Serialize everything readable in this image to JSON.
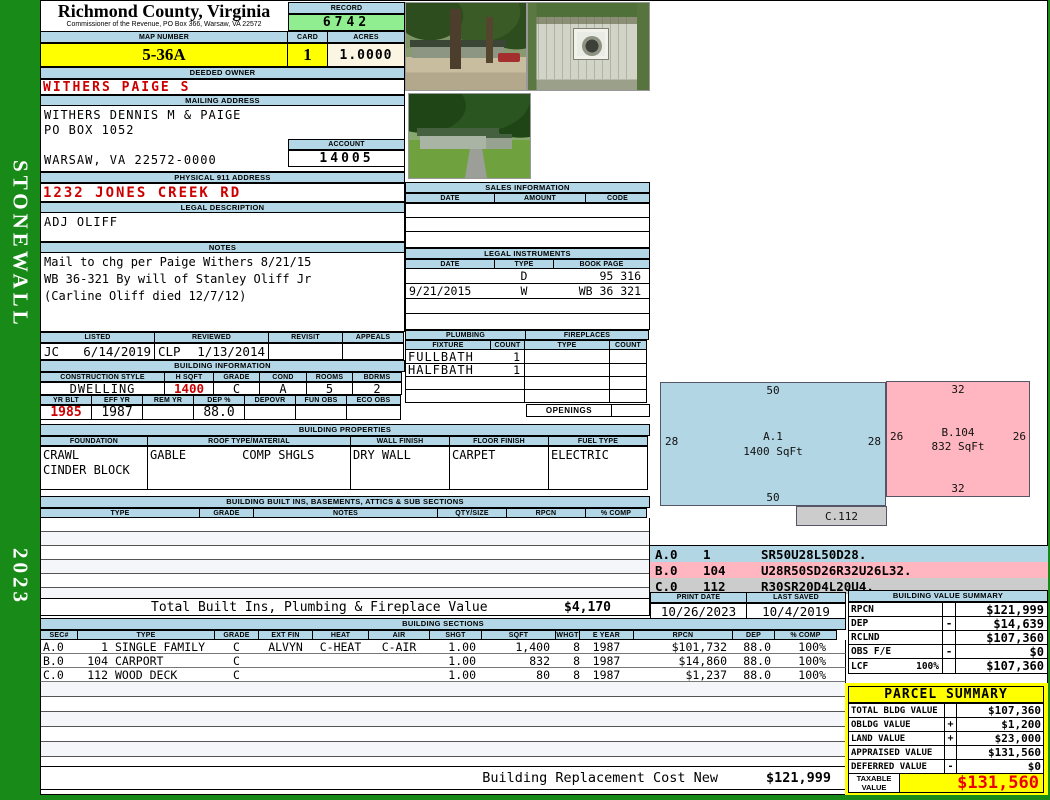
{
  "sidebar": {
    "district": "STONEWALL",
    "year": "2023"
  },
  "header": {
    "county": "Richmond County, Virginia",
    "commissioner": "Commissioner of the Revenue, PO Box 366, Warsaw, VA 22572",
    "record_label": "RECORD",
    "record_number": "6742",
    "map_number_label": "MAP NUMBER",
    "map_number": "5-36A",
    "card_label": "CARD",
    "card_number": "1",
    "acres_label": "ACRES",
    "acres": "1.0000"
  },
  "owner": {
    "deeded_owner_label": "DEEDED OWNER",
    "deeded_owner": "WITHERS PAIGE S",
    "mailing_address_label": "MAILING ADDRESS",
    "mailing_line1": "WITHERS DENNIS M & PAIGE",
    "mailing_line2": "PO BOX 1052",
    "mailing_line3": "WARSAW, VA 22572-0000",
    "account_label": "ACCOUNT",
    "account_number": "14005",
    "physical_address_label": "PHYSICAL 911 ADDRESS",
    "physical_address": "1232 JONES CREEK RD",
    "legal_description_label": "LEGAL DESCRIPTION",
    "legal_description": "ADJ OLIFF",
    "notes_label": "NOTES",
    "notes_line1": "Mail to chg per Paige Withers 8/21/15",
    "notes_line2": "WB 36-321 By will of Stanley Oliff Jr",
    "notes_line3": "(Carline Oliff died 12/7/12)"
  },
  "review": {
    "listed_label": "LISTED",
    "reviewed_label": "REVIEWED",
    "revisit_label": "REVISIT",
    "appeals_label": "APPEALS",
    "listed_by": "JC",
    "listed_date": "6/14/2019",
    "reviewed_by": "CLP",
    "reviewed_date": "1/13/2014",
    "revisit": "",
    "appeals": ""
  },
  "building_info": {
    "label": "BUILDING INFORMATION",
    "construction_style_label": "CONSTRUCTION STYLE",
    "construction_style": "DWELLING",
    "hsqft_label": "H SQFT",
    "hsqft": "1400",
    "grade_label": "GRADE",
    "grade": "C",
    "cond_label": "COND",
    "cond": "A",
    "rooms_label": "ROOMS",
    "rooms": "5",
    "bdrms_label": "BDRMS",
    "bdrms": "2",
    "yr_blt_label": "YR BLT",
    "yr_blt": "1985",
    "eff_yr_label": "EFF YR",
    "eff_yr": "1987",
    "rem_yr_label": "REM YR",
    "rem_yr": "",
    "dep_label": "DEP %",
    "dep": "88.0",
    "depovr_label": "DEPOVR",
    "depovr": "",
    "fun_obs_label": "FUN OBS",
    "fun_obs": "",
    "eco_obs_label": "ECO OBS",
    "eco_obs": ""
  },
  "building_properties": {
    "label": "BUILDING PROPERTIES",
    "foundation_label": "FOUNDATION",
    "foundation_line1": "CRAWL",
    "foundation_line2": "CINDER BLOCK",
    "roof_label": "ROOF TYPE/MATERIAL",
    "roof_type": "GABLE",
    "roof_material": "COMP SHGLS",
    "wall_finish_label": "WALL FINISH",
    "wall_finish": "DRY WALL",
    "floor_finish_label": "FLOOR FINISH",
    "floor_finish": "CARPET",
    "fuel_type_label": "FUEL TYPE",
    "fuel_type": "ELECTRIC"
  },
  "built_ins": {
    "label": "BUILDING BUILT INS, BASEMENTS, ATTICS & SUB SECTIONS",
    "headers": [
      "TYPE",
      "GRADE",
      "NOTES",
      "QTY/SIZE",
      "RPCN",
      "% COMP"
    ],
    "total_label": "Total Built Ins, Plumbing & Fireplace Value",
    "total_value": "$4,170"
  },
  "sales": {
    "label": "SALES INFORMATION",
    "headers": [
      "DATE",
      "AMOUNT",
      "CODE"
    ]
  },
  "legal_instruments": {
    "label": "LEGAL INSTRUMENTS",
    "headers": [
      "DATE",
      "TYPE",
      "BOOK PAGE"
    ],
    "rows": [
      [
        "",
        "D",
        "95 316"
      ],
      [
        "9/21/2015",
        "W",
        "WB 36 321"
      ],
      [
        "",
        "",
        ""
      ],
      [
        "",
        "",
        ""
      ]
    ]
  },
  "plumbing": {
    "label": "PLUMBING",
    "fixture_label": "FIXTURE",
    "count_label": "COUNT",
    "rows": [
      [
        "FULLBATH",
        "1"
      ],
      [
        "HALFBATH",
        "1"
      ],
      [
        "",
        ""
      ],
      [
        "",
        ""
      ]
    ]
  },
  "fireplaces": {
    "label": "FIREPLACES",
    "type_label": "TYPE",
    "count_label": "COUNT",
    "openings_label": "OPENINGS"
  },
  "sketch": {
    "shapes": [
      {
        "label": "A.1",
        "sqft": "1400 SqFt",
        "top": "50",
        "bottom": "50",
        "left": "28",
        "right": "28"
      },
      {
        "label": "B.104",
        "sqft": "832 SqFt",
        "top": "32",
        "bottom": "32",
        "left": "26",
        "right": "26"
      },
      {
        "label": "C.112"
      }
    ],
    "codes": [
      {
        "sec": "A.0",
        "num": "1",
        "path": "SR50U28L50D28."
      },
      {
        "sec": "B.0",
        "num": "104",
        "path": "U28R50SD26R32U26L32."
      },
      {
        "sec": "C.0",
        "num": "112",
        "path": "R30SR20D4L20U4."
      }
    ]
  },
  "dates": {
    "print_date_label": "PRINT DATE",
    "print_date": "10/26/2023",
    "last_saved_label": "LAST SAVED",
    "last_saved": "10/4/2019"
  },
  "building_sections": {
    "label": "BUILDING SECTIONS",
    "headers": [
      "SEC#",
      "TYPE",
      "GRADE",
      "EXT FIN",
      "HEAT",
      "AIR",
      "SHGT",
      "SQFT",
      "WHGT",
      "E YEAR",
      "RPCN",
      "DEP",
      "% COMP"
    ],
    "rows": [
      {
        "sec": "A.0",
        "num": "1",
        "type": "SINGLE FAMILY",
        "grade": "C",
        "ext_fin": "ALVYN",
        "heat": "C-HEAT",
        "air": "C-AIR",
        "shgt": "1.00",
        "sqft": "1,400",
        "whgt": "8",
        "eyear": "1987",
        "rpcn": "$101,732",
        "dep": "88.0",
        "comp": "100%"
      },
      {
        "sec": "B.0",
        "num": "104",
        "type": "CARPORT",
        "grade": "C",
        "ext_fin": "",
        "heat": "",
        "air": "",
        "shgt": "1.00",
        "sqft": "832",
        "whgt": "8",
        "eyear": "1987",
        "rpcn": "$14,860",
        "dep": "88.0",
        "comp": "100%"
      },
      {
        "sec": "C.0",
        "num": "112",
        "type": "WOOD DECK",
        "grade": "C",
        "ext_fin": "",
        "heat": "",
        "air": "",
        "shgt": "1.00",
        "sqft": "80",
        "whgt": "8",
        "eyear": "1987",
        "rpcn": "$1,237",
        "dep": "88.0",
        "comp": "100%"
      }
    ],
    "replacement_label": "Building Replacement Cost New",
    "replacement_value": "$121,999"
  },
  "building_value_summary": {
    "label": "BUILDING VALUE SUMMARY",
    "rows": [
      {
        "name": "RPCN",
        "pct": "",
        "op": "",
        "value": "$121,999"
      },
      {
        "name": "DEP",
        "pct": "",
        "op": "-",
        "value": "$14,639"
      },
      {
        "name": "RCLND",
        "pct": "",
        "op": "",
        "value": "$107,360"
      },
      {
        "name": "OBS F/E",
        "pct": "",
        "op": "-",
        "value": "$0"
      },
      {
        "name": "LCF",
        "pct": "100%",
        "op": "",
        "value": "$107,360"
      }
    ]
  },
  "parcel_summary": {
    "label": "PARCEL SUMMARY",
    "rows": [
      {
        "name": "TOTAL BLDG VALUE",
        "op": "",
        "value": "$107,360"
      },
      {
        "name": "OBLDG VALUE",
        "op": "+",
        "value": "$1,200"
      },
      {
        "name": "LAND VALUE",
        "op": "+",
        "value": "$23,000"
      },
      {
        "name": "APPRAISED VALUE",
        "op": "",
        "value": "$131,560"
      },
      {
        "name": "DEFERRED VALUE",
        "op": "-",
        "value": "$0"
      }
    ],
    "taxable_label": "TAXABLE VALUE",
    "taxable_value": "$131,560"
  },
  "photos": {
    "photo1": "street view with trees and red car",
    "photo2": "outbuilding close-up",
    "photo3": "front lawn view of house"
  },
  "colors": {
    "sidebar_green": "#178a17",
    "header_blue": "#b3d7e6",
    "highlight_yellow": "#ffff00",
    "record_green": "#90ee90",
    "acres_cream": "#faf6e3",
    "value_red": "#cc0000",
    "sketch_blue": "#b2d6e4",
    "sketch_pink": "#ffb6c1",
    "sketch_gray": "#cccccc"
  }
}
